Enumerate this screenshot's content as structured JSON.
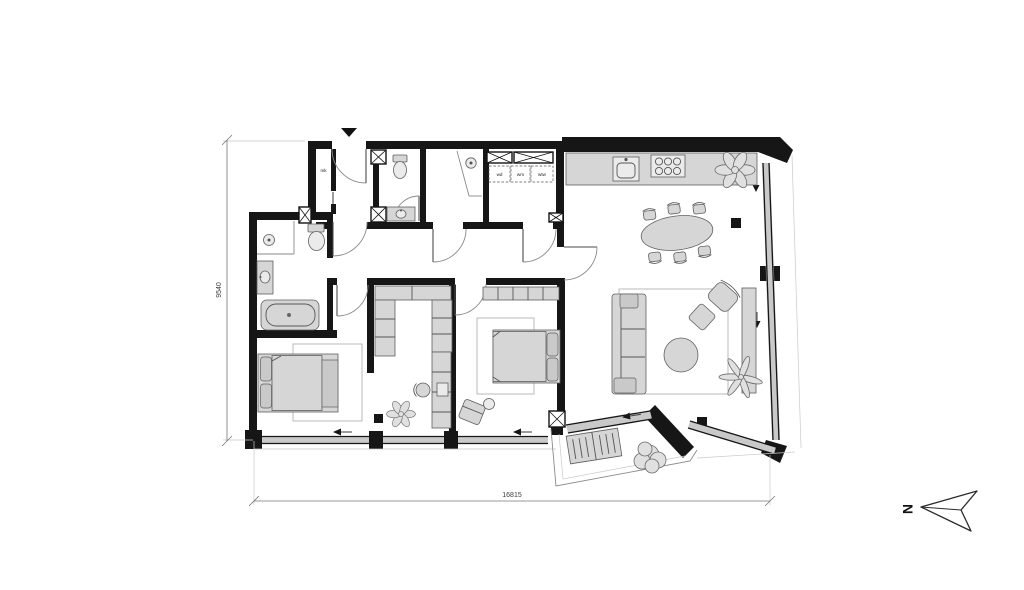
{
  "plan": {
    "dimensions": {
      "height": "9540",
      "width": "16815"
    },
    "compass": {
      "north": "N"
    },
    "labels": {
      "meter_cabinet": "mk",
      "dryer": "wd",
      "washer": "wm",
      "heat_recovery": "wtw"
    },
    "colors": {
      "background": "#ffffff",
      "wall": "#161616",
      "furniture_fill": "#d6d6d6",
      "furniture_stroke": "#5f5f5f",
      "glass_fill": "#c9c9c9",
      "rug_stroke": "#b3b3b3",
      "arc_stroke": "#8a8a8a",
      "dim_stroke": "#777777",
      "text": "#3c3c3c"
    }
  }
}
